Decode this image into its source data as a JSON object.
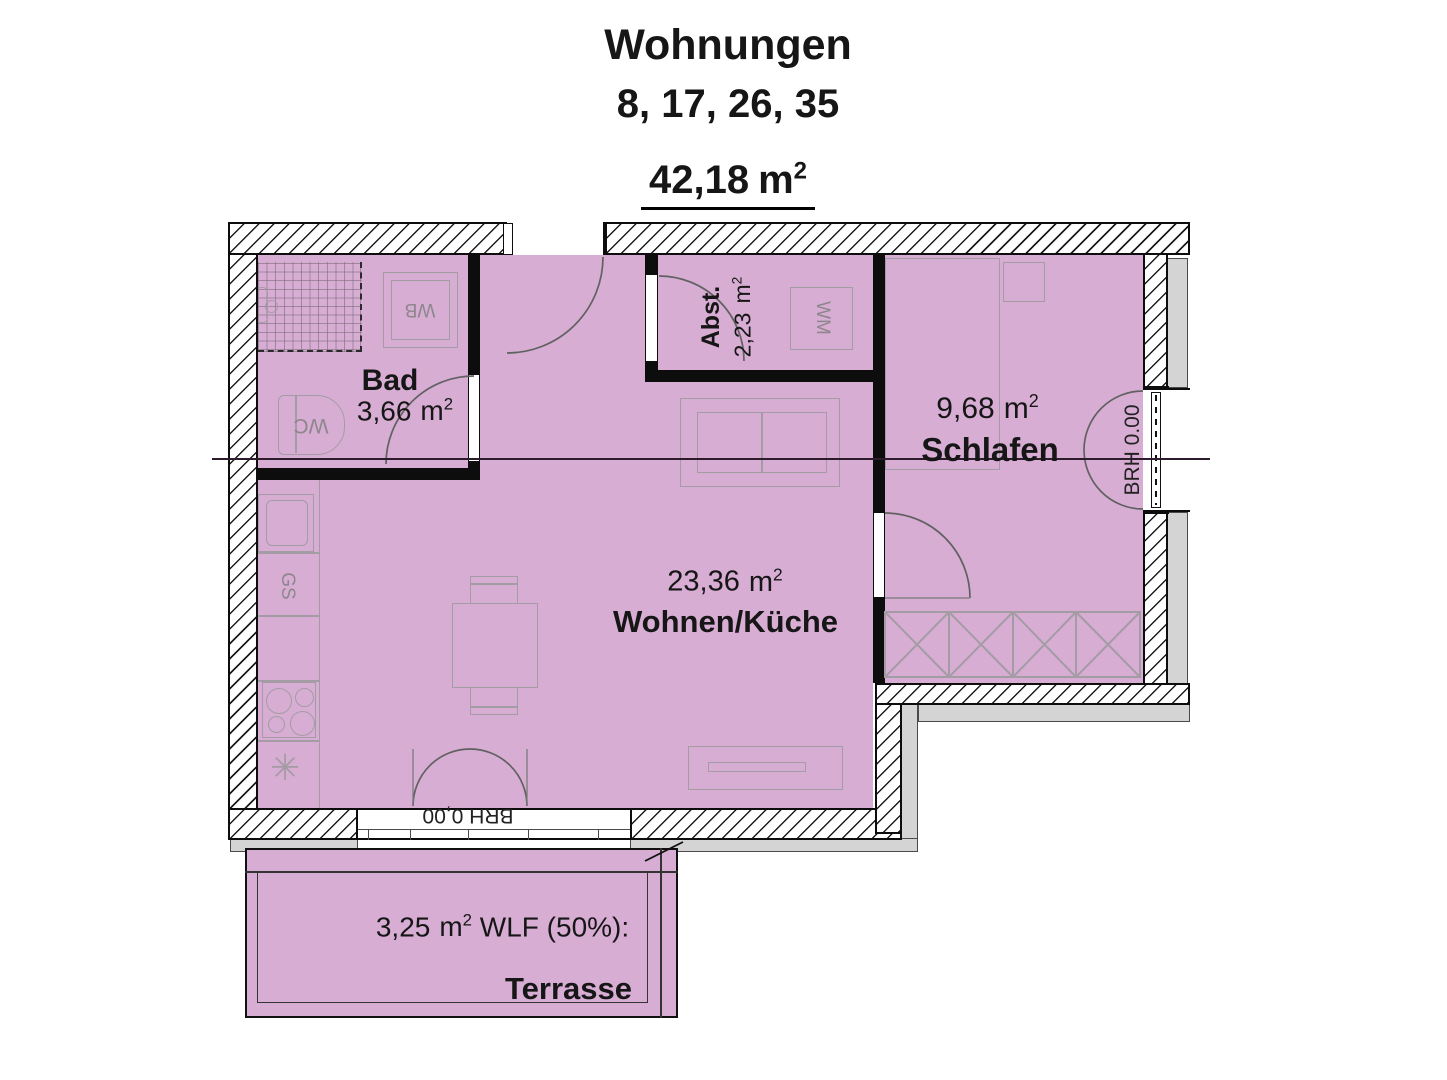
{
  "title": {
    "line1": "Wohnungen",
    "line2": "8, 17, 26, 35",
    "area": "42,18"
  },
  "shared": {
    "unit": "m",
    "sup": "2"
  },
  "rooms": {
    "bad": {
      "name": "Bad",
      "area": "3,66"
    },
    "abst": {
      "name": "Abst.",
      "area": "2,23"
    },
    "schlafen": {
      "name": "Schlafen",
      "area": "9,68"
    },
    "wohnen": {
      "name": "Wohnen/Küche",
      "area": "23,36"
    },
    "terrasse": {
      "name": "Terrasse",
      "area": "3,25",
      "wlf": "WLF (50%):"
    }
  },
  "fixtures": {
    "wb": "WB",
    "wc": "WC",
    "gs": "GS",
    "wm": "WM",
    "star": "✳"
  },
  "annotations": {
    "brh_window": "BRH 0.00",
    "brh_door": "BRH 0,00"
  },
  "colors": {
    "room_fill": "#d7add3",
    "wall": "#0d0d0d",
    "furniture": "#a49ca4",
    "shadow": "#d4d4d4",
    "label_gray": "#8d878d",
    "section": "#2c1c2c"
  }
}
